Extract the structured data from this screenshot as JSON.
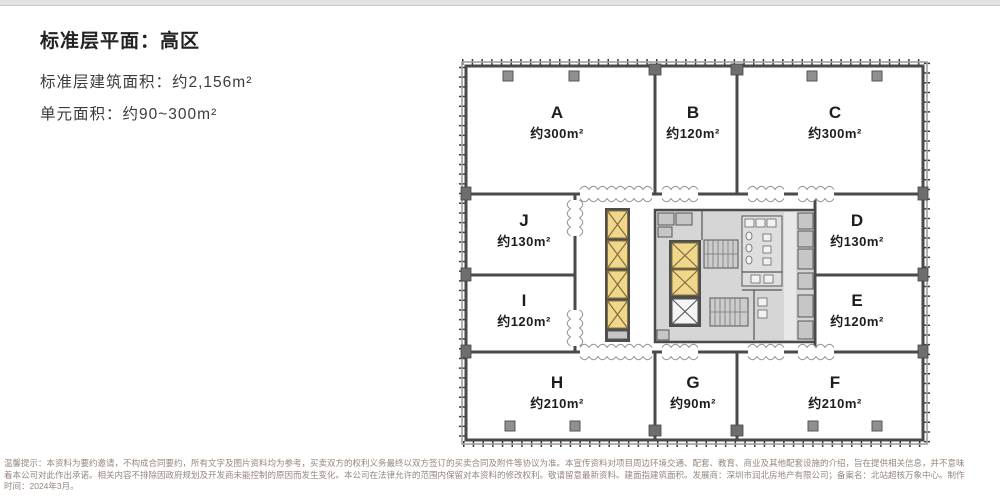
{
  "header": {
    "title": "标准层平面：高区",
    "line1": "标准层建筑面积：约2,156m²",
    "line2": "单元面积：约90~300m²"
  },
  "plan": {
    "units": [
      {
        "name": "A",
        "area": "约300m²"
      },
      {
        "name": "B",
        "area": "约120m²"
      },
      {
        "name": "C",
        "area": "约300m²"
      },
      {
        "name": "J",
        "area": "约130m²"
      },
      {
        "name": "D",
        "area": "约130m²"
      },
      {
        "name": "I",
        "area": "约120m²"
      },
      {
        "name": "E",
        "area": "约120m²"
      },
      {
        "name": "H",
        "area": "约210m²"
      },
      {
        "name": "G",
        "area": "约90m²"
      },
      {
        "name": "F",
        "area": "约210m²"
      }
    ],
    "colors": {
      "elevator_yellow": "#f0d78c",
      "core_gray": "#d6d6d6",
      "wall_dark": "#4a4a4a",
      "column_gray": "#909090"
    }
  },
  "disclaimer": {
    "line1": "温馨提示：本资料为要约邀请，不构成合同要约，所有文字及图片资料均为参考，买卖双方的权利义务最终以双方签订的买卖合同及附件等协议为准。本宣传资料对项目周边环境交通、配套、教育、商业及其他配套设施的介绍，旨在提供相关信息，并不意味",
    "line2": "着本公司对此作出承诺。相关内容不排除因政府规划及开发商未能控制的原因而发生变化。本公司在法律允许的范围内保留对本资料的修改权利。敬请留意最新资料。建面指建筑面积。发展商：深圳市润北房地产有限公司；备案名：北站超核万象中心。制作",
    "line3": "时间：2024年3月。"
  }
}
